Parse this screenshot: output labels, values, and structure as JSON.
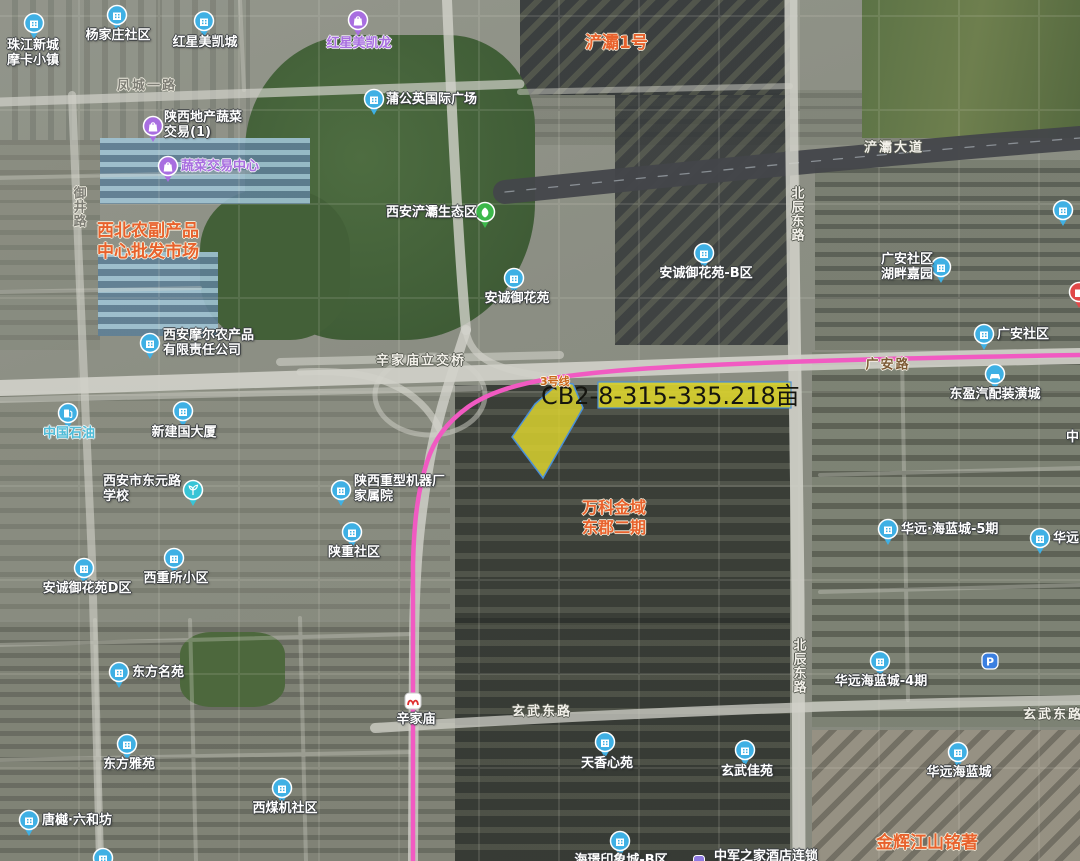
{
  "parcel": {
    "code_label": "CB2-8-315-335.218亩",
    "fill": "#d9d12f",
    "outline": "#4a90d9"
  },
  "metro_line": {
    "name": "3号线",
    "color": "#f15ac2",
    "station": {
      "name": "辛家庙"
    }
  },
  "colors": {
    "poi_blue": "#3fb0e4",
    "poi_purple": "#a86ee0",
    "poi_green": "#3cb84a",
    "poi_cyan": "#38c4d6",
    "parking_blue": "#3b7fe0",
    "hotel_purple": "#8f7ae0",
    "red_pin": "#e04848",
    "area_orange": "#e8622d",
    "metro_logo_red": "#e03030"
  },
  "pois": [
    {
      "name": "珠江新城\n摩卡小镇",
      "type": "building",
      "icon": {
        "x": 34,
        "y": 23
      },
      "label": {
        "x": 7,
        "y": 38,
        "anchor": "left"
      }
    },
    {
      "name": "杨家庄社区",
      "type": "building",
      "icon": {
        "x": 117,
        "y": 15
      },
      "label": {
        "x": 118,
        "y": 28,
        "anchor": "center"
      }
    },
    {
      "name": "红星美凯城",
      "type": "building",
      "icon": {
        "x": 204,
        "y": 21
      },
      "label": {
        "x": 205,
        "y": 35,
        "anchor": "center"
      }
    },
    {
      "name": "红星美凯龙",
      "type": "bag",
      "icon": {
        "x": 358,
        "y": 20
      },
      "label": {
        "x": 359,
        "y": 36,
        "anchor": "center",
        "color": "purple"
      }
    },
    {
      "name": "蒲公英国际广场",
      "type": "building",
      "icon": {
        "x": 374,
        "y": 99
      },
      "label": {
        "x": 386,
        "y": 92,
        "anchor": "left"
      }
    },
    {
      "name": "陕西地产蔬菜\n交易(1)",
      "type": "bag",
      "icon": {
        "x": 153,
        "y": 126
      },
      "label": {
        "x": 164,
        "y": 110,
        "anchor": "left"
      }
    },
    {
      "name": "蔬菜交易中心",
      "type": "bag",
      "icon": {
        "x": 168,
        "y": 166
      },
      "label": {
        "x": 181,
        "y": 159,
        "anchor": "left",
        "color": "purple"
      }
    },
    {
      "name": "西安浐灞生态区",
      "type": "leaf",
      "icon": {
        "x": 485,
        "y": 212
      },
      "label": {
        "x": 477,
        "y": 205,
        "anchor": "right"
      }
    },
    {
      "name": "安诚御花苑",
      "type": "building",
      "icon": {
        "x": 514,
        "y": 278
      },
      "label": {
        "x": 517,
        "y": 291,
        "anchor": "center"
      }
    },
    {
      "name": "安诚御花苑-B区",
      "type": "building",
      "icon": {
        "x": 704,
        "y": 253
      },
      "label": {
        "x": 706,
        "y": 266,
        "anchor": "center"
      }
    },
    {
      "name": "广安社区\n湖畔嘉园",
      "type": "building",
      "icon": {
        "x": 941,
        "y": 267
      },
      "label": {
        "x": 933,
        "y": 252,
        "anchor": "right"
      }
    },
    {
      "name": "广安社区",
      "type": "building",
      "icon": {
        "x": 984,
        "y": 334
      },
      "label": {
        "x": 997,
        "y": 327,
        "anchor": "left"
      }
    },
    {
      "name": "东盈汽配装潢城",
      "type": "car",
      "icon": {
        "x": 995,
        "y": 374
      },
      "label": {
        "x": 995,
        "y": 387,
        "anchor": "center"
      }
    },
    {
      "name": "西安摩尔农产品\n有限责任公司",
      "type": "building",
      "icon": {
        "x": 150,
        "y": 343
      },
      "label": {
        "x": 163,
        "y": 328,
        "anchor": "left"
      }
    },
    {
      "name": "中国石油",
      "type": "gas",
      "icon": {
        "x": 68,
        "y": 413
      },
      "label": {
        "x": 69,
        "y": 426,
        "anchor": "center",
        "color": "teal"
      }
    },
    {
      "name": "新建国大厦",
      "type": "building",
      "icon": {
        "x": 183,
        "y": 411
      },
      "label": {
        "x": 184,
        "y": 425,
        "anchor": "center"
      }
    },
    {
      "name": "西安市东元路\n学校",
      "type": "school",
      "icon": {
        "x": 193,
        "y": 490
      },
      "label": {
        "x": 142,
        "y": 474,
        "anchor": "center"
      }
    },
    {
      "name": "陕西重型机器厂\n家属院",
      "type": "building",
      "icon": {
        "x": 341,
        "y": 490
      },
      "label": {
        "x": 354,
        "y": 474,
        "anchor": "left"
      }
    },
    {
      "name": "陕重社区",
      "type": "building",
      "icon": {
        "x": 352,
        "y": 532
      },
      "label": {
        "x": 354,
        "y": 545,
        "anchor": "center"
      }
    },
    {
      "name": "西重所小区",
      "type": "building",
      "icon": {
        "x": 174,
        "y": 558
      },
      "label": {
        "x": 176,
        "y": 571,
        "anchor": "center"
      }
    },
    {
      "name": "安诚御花苑D区",
      "type": "building",
      "icon": {
        "x": 84,
        "y": 568
      },
      "label": {
        "x": 87,
        "y": 581,
        "anchor": "center"
      }
    },
    {
      "name": "东方名苑",
      "type": "building",
      "icon": {
        "x": 119,
        "y": 672
      },
      "label": {
        "x": 132,
        "y": 665,
        "anchor": "left"
      }
    },
    {
      "name": "东方雅苑",
      "type": "building",
      "icon": {
        "x": 127,
        "y": 744
      },
      "label": {
        "x": 129,
        "y": 757,
        "anchor": "center"
      }
    },
    {
      "name": "西煤机社区",
      "type": "building",
      "icon": {
        "x": 282,
        "y": 788
      },
      "label": {
        "x": 285,
        "y": 801,
        "anchor": "center"
      }
    },
    {
      "name": "唐樾·六和坊",
      "type": "building",
      "icon": {
        "x": 29,
        "y": 820
      },
      "label": {
        "x": 42,
        "y": 813,
        "anchor": "left"
      }
    },
    {
      "name": "天香心苑",
      "type": "building",
      "icon": {
        "x": 605,
        "y": 742
      },
      "label": {
        "x": 607,
        "y": 756,
        "anchor": "center"
      }
    },
    {
      "name": "玄武佳苑",
      "type": "building",
      "icon": {
        "x": 745,
        "y": 750
      },
      "label": {
        "x": 747,
        "y": 764,
        "anchor": "center"
      }
    },
    {
      "name": "华远·海蓝城-5期",
      "type": "building",
      "icon": {
        "x": 888,
        "y": 529
      },
      "label": {
        "x": 901,
        "y": 522,
        "anchor": "left"
      }
    },
    {
      "name": "华远海蓝城-4期",
      "type": "building",
      "icon": {
        "x": 880,
        "y": 661
      },
      "label": {
        "x": 881,
        "y": 674,
        "anchor": "center"
      }
    },
    {
      "name": "华远海蓝城",
      "type": "building",
      "icon": {
        "x": 958,
        "y": 752
      },
      "label": {
        "x": 959,
        "y": 765,
        "anchor": "center"
      }
    },
    {
      "name": "",
      "type": "parking",
      "icon": {
        "x": 990,
        "y": 661
      }
    },
    {
      "name": "海璟印象城-B区",
      "type": "building",
      "icon": {
        "x": 620,
        "y": 841
      },
      "label": {
        "x": 621,
        "y": 853,
        "anchor": "center"
      }
    },
    {
      "name": "中军之家酒店连锁",
      "type": "hotelsq",
      "icon": {
        "x": 699,
        "y": 858
      },
      "label": {
        "x": 766,
        "y": 849,
        "anchor": "center"
      }
    },
    {
      "name": "华远",
      "type": "building",
      "icon": {
        "x": 1040,
        "y": 538
      },
      "label": {
        "x": 1053,
        "y": 531,
        "anchor": "left"
      }
    },
    {
      "name": "",
      "type": "building",
      "icon": {
        "x": 1063,
        "y": 210
      }
    },
    {
      "name": "",
      "type": "red",
      "icon": {
        "x": 1079,
        "y": 292
      }
    },
    {
      "name": "中",
      "type": "none",
      "label": {
        "x": 1066,
        "y": 430,
        "anchor": "left"
      }
    },
    {
      "name": "",
      "type": "building",
      "icon": {
        "x": 103,
        "y": 858
      }
    }
  ],
  "roads": [
    {
      "name": "凤城一路",
      "x": 147,
      "y": 84,
      "orient": "h",
      "style": "gray"
    },
    {
      "name": "御井路",
      "x": 78,
      "y": 186,
      "orient": "v",
      "style": "gray"
    },
    {
      "name": "浐灞大道",
      "x": 894,
      "y": 146,
      "orient": "h",
      "style": "light"
    },
    {
      "name": "北辰东路",
      "x": 796,
      "y": 186,
      "orient": "v",
      "style": "light"
    },
    {
      "name": "辛家庙立交桥",
      "x": 421,
      "y": 359,
      "orient": "h",
      "style": "light"
    },
    {
      "name": "广安路",
      "x": 888,
      "y": 363,
      "orient": "h",
      "style": "brown"
    },
    {
      "name": "玄武东路",
      "x": 542,
      "y": 710,
      "orient": "h",
      "style": "light"
    },
    {
      "name": "北辰东路",
      "x": 798,
      "y": 638,
      "orient": "v",
      "style": "light"
    },
    {
      "name": "玄武东路",
      "x": 1053,
      "y": 713,
      "orient": "h",
      "style": "light"
    }
  ],
  "areas": [
    {
      "text": "浐灞1号",
      "x": 585,
      "y": 33,
      "size": 17
    },
    {
      "text": "西北农副产品\n中心批发市场",
      "x": 97,
      "y": 221,
      "size": 17
    },
    {
      "text": "万科金域\n东郡二期",
      "x": 582,
      "y": 498,
      "size": 16
    },
    {
      "text": "金辉江山铭著",
      "x": 876,
      "y": 833,
      "size": 17
    }
  ]
}
